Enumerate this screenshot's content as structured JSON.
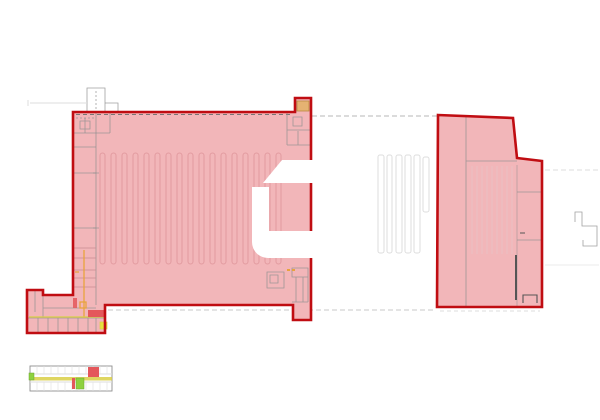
{
  "page": {
    "description": "Architectural site floor plan with two highlighted warehouse units, logo watermark and small overview plan",
    "background": "#ffffff"
  },
  "colors": {
    "background": "#ffffff",
    "outline_red": "#c00d12",
    "unit_fill": "#f2b6b9",
    "rack_line": "#e29ba0",
    "rack_faint": "#e7c3c6",
    "gray_line": "#8f8f8f",
    "gray_dark": "#555555",
    "gray_faint": "#dedede",
    "pink_partition": "#c88d92",
    "orange": "#e8a33c",
    "tan": "#e5b272",
    "tan_border": "#b9893f",
    "yellow_line": "#d9cf45",
    "yellow_block": "#e6e23c",
    "green": "#8ed13f",
    "green_border": "#6aa32e",
    "accent_red_block": "#e4575b",
    "watermark": "#ffffff"
  },
  "plan": {
    "units": [
      {
        "id": "left-warehouse-unit",
        "highlighted": true
      },
      {
        "id": "right-warehouse-unit",
        "highlighted": true
      }
    ],
    "overlays": [
      "logo-watermark",
      "mini-overview-plan",
      "dashed-connector-lines",
      "entrance-canopy",
      "loading-dock-stripes",
      "outbuilding-outline"
    ]
  }
}
